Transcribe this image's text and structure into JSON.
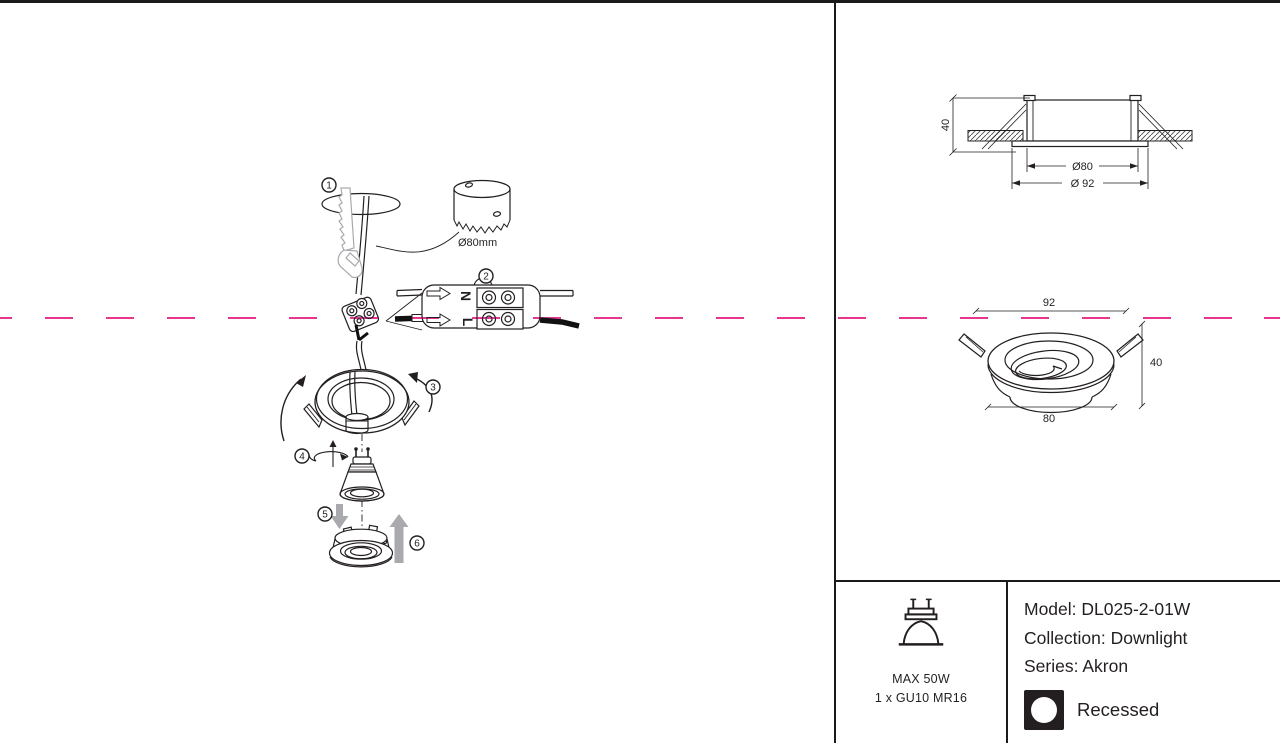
{
  "colors": {
    "ink": "#231f20",
    "gray": "#a8aaad",
    "magenta": "#e8368f"
  },
  "steps": {
    "s1": "1",
    "s2": "2",
    "s3": "3",
    "s4": "4",
    "s5": "5",
    "s6": "6"
  },
  "labels": {
    "hole_saw": "Ø80mm",
    "terminal_n": "N",
    "terminal_l": "L"
  },
  "dimensions": {
    "section_height": "40",
    "section_cutout": "Ø80",
    "section_outer": "Ø 92",
    "persp_top": "92",
    "persp_height": "40",
    "persp_bottom": "80"
  },
  "spec": {
    "max_power": "MAX 50W",
    "lamp": "1 x GU10 MR16",
    "model": "Model: DL025-2-01W",
    "collection": "Collection: Downlight",
    "series": "Series: Akron",
    "mounting": "Recessed"
  }
}
